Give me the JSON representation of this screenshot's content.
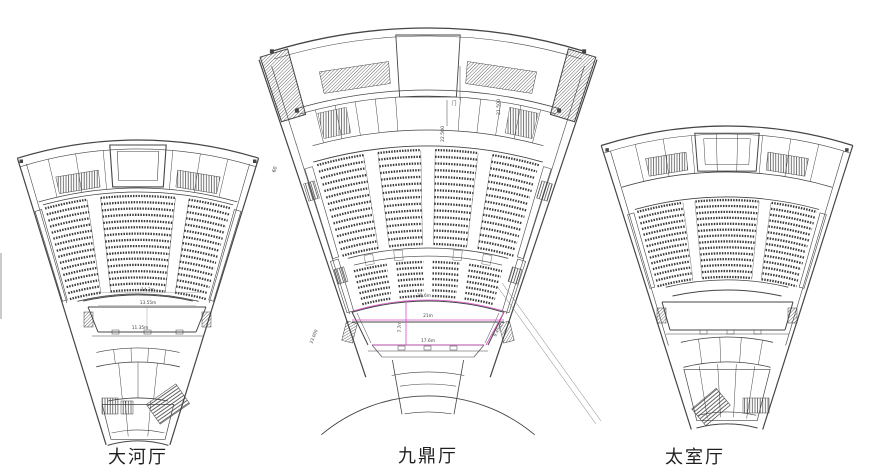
{
  "colors": {
    "line": "#454545",
    "seat": "#3a3a3a",
    "dimension": "#d94fc6",
    "annotation": "#7a7a7a",
    "caption": "#1f1f1f",
    "edge_artifact": "#cbcbcb"
  },
  "halls": [
    {
      "caption": "大河厅",
      "dims": {
        "proscenium_arc": "14.3m",
        "opening": "13.55m",
        "stage_back": "11.35m"
      }
    },
    {
      "caption": "九鼎厅",
      "dims": {
        "proscenium_arc": "20.6m",
        "opening": "21m",
        "stage_depth": "7.7m",
        "stage_back": "17.6m",
        "stage_side": "9.45m"
      },
      "elevations": {
        "upper": "22.500",
        "lower": "21.500",
        "side": "23.000"
      },
      "grid_axis": "60",
      "door": "门"
    },
    {
      "caption": "太室厅"
    }
  ]
}
